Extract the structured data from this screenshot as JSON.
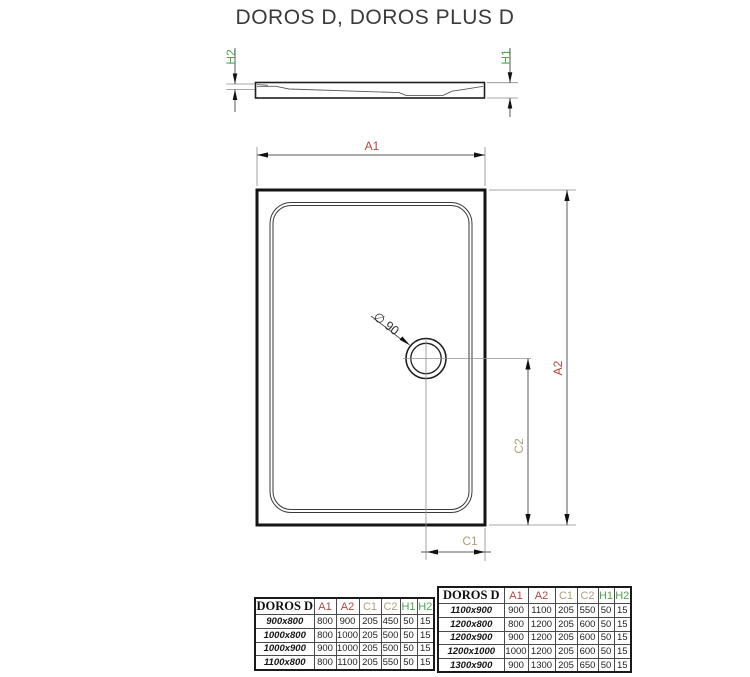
{
  "title": "DOROS D, DOROS PLUS D",
  "colors": {
    "dimension_a": "#b4453f",
    "dimension_c": "#aca07f",
    "dimension_h": "#4fa44f",
    "drawing_line": "#1f1f1f"
  },
  "diagram": {
    "profile": {
      "h1": "H1",
      "h2": "H2"
    },
    "plan": {
      "a1": "A1",
      "a2": "A2",
      "c1": "C1",
      "c2": "C2",
      "drain_diameter": "∅ 90"
    }
  },
  "tables": [
    {
      "header": {
        "model": "DOROS D",
        "cols": [
          "A1",
          "A2",
          "C1",
          "C2",
          "H1",
          "H2"
        ]
      },
      "rows": [
        {
          "model": "900x800",
          "values": [
            800,
            900,
            205,
            450,
            50,
            15
          ]
        },
        {
          "model": "1000x800",
          "values": [
            800,
            1000,
            205,
            500,
            50,
            15
          ]
        },
        {
          "model": "1000x900",
          "values": [
            900,
            1000,
            205,
            500,
            50,
            15
          ]
        },
        {
          "model": "1100x800",
          "values": [
            800,
            1100,
            205,
            550,
            50,
            15
          ]
        }
      ]
    },
    {
      "header": {
        "model": "DOROS D",
        "cols": [
          "A1",
          "A2",
          "C1",
          "C2",
          "H1",
          "H2"
        ]
      },
      "rows": [
        {
          "model": "1100x900",
          "values": [
            900,
            1100,
            205,
            550,
            50,
            15
          ]
        },
        {
          "model": "1200x800",
          "values": [
            800,
            1200,
            205,
            600,
            50,
            15
          ]
        },
        {
          "model": "1200x900",
          "values": [
            900,
            1200,
            205,
            600,
            50,
            15
          ]
        },
        {
          "model": "1200x1000",
          "values": [
            1000,
            1200,
            205,
            600,
            50,
            15
          ]
        },
        {
          "model": "1300x900",
          "values": [
            900,
            1300,
            205,
            650,
            50,
            15
          ]
        }
      ]
    }
  ]
}
